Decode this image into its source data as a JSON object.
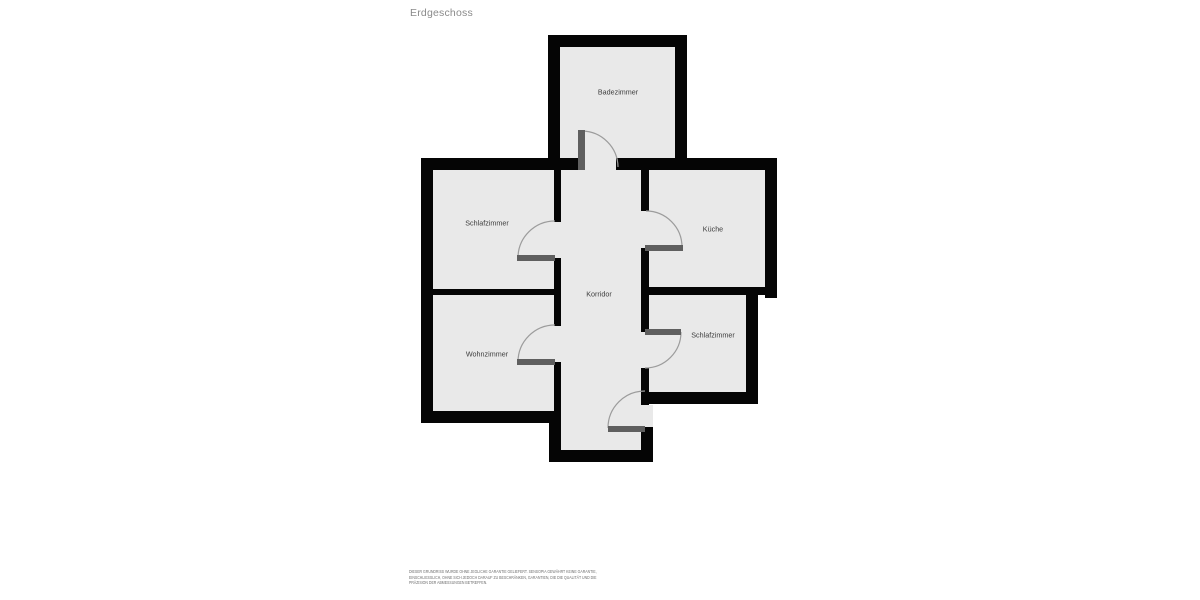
{
  "page": {
    "title": "Erdgeschoss"
  },
  "floor_plan": {
    "rooms": [
      {
        "id": "badezimmer",
        "label": "Badezimmer"
      },
      {
        "id": "schlafzimmer-1",
        "label": "Schlafzimmer"
      },
      {
        "id": "kueche",
        "label": "Küche"
      },
      {
        "id": "korridor",
        "label": "Korridor"
      },
      {
        "id": "wohnzimmer",
        "label": "Wohnzimmer"
      },
      {
        "id": "schlafzimmer-2",
        "label": "Schlafzimmer"
      }
    ],
    "door_count": 6,
    "colors": {
      "background": "#ffffff",
      "wall": "#050505",
      "room_fill": "#e9e9e9",
      "door_leaf": "#5f5f5f",
      "door_arc": "#9c9c9c",
      "label_text": "#3d3d3d",
      "title_text": "#8a8a8a",
      "disclaimer_text": "#6f6f6f"
    }
  },
  "disclaimer": {
    "lines": [
      "DIESER GRUNDRISS WURDE OHNE JEGLICHE GARANTIE GELIEFERT. SENSOPIA GEWÄHRT KEINE GARANTIE,",
      "EINSCHLIESSLICH, OHNE SICH JEDOCH DARAUF ZU BESCHRÄNKEN, GARANTIEN, DIE DIE QUALITÄT UND DIE",
      "PRÄZISION DER ABMESSUNGEN BETREFFEN."
    ]
  }
}
